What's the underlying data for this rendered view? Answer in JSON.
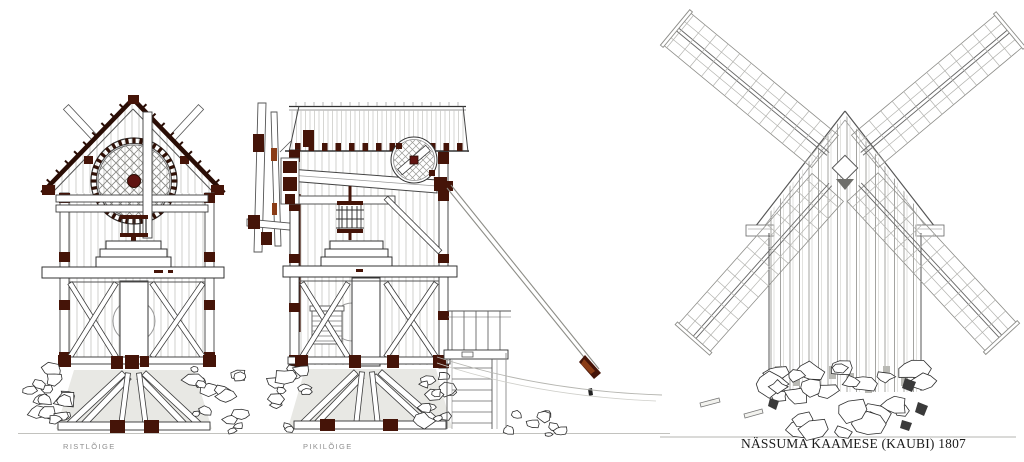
{
  "labels": {
    "cross_section": "RISTLÕIGE",
    "longitudinal_section": "PIKILÕIGE",
    "title": "NÄSSUMA KAAMESE (KAUBI) 1807"
  },
  "colors": {
    "paper": "#ffffff",
    "timber": "#451408",
    "timber_red": "#5f1310",
    "accent_orange": "#8a3c16",
    "ink": "#2a0d05",
    "line_dark": "#333333",
    "line_medium": "#555555",
    "line_light": "#aaaaaa",
    "plank": "#c4c4c0",
    "ground_fill": "#e8e8e4",
    "label_gray": "#8f8f8f",
    "title_color": "#1b1b1b"
  }
}
